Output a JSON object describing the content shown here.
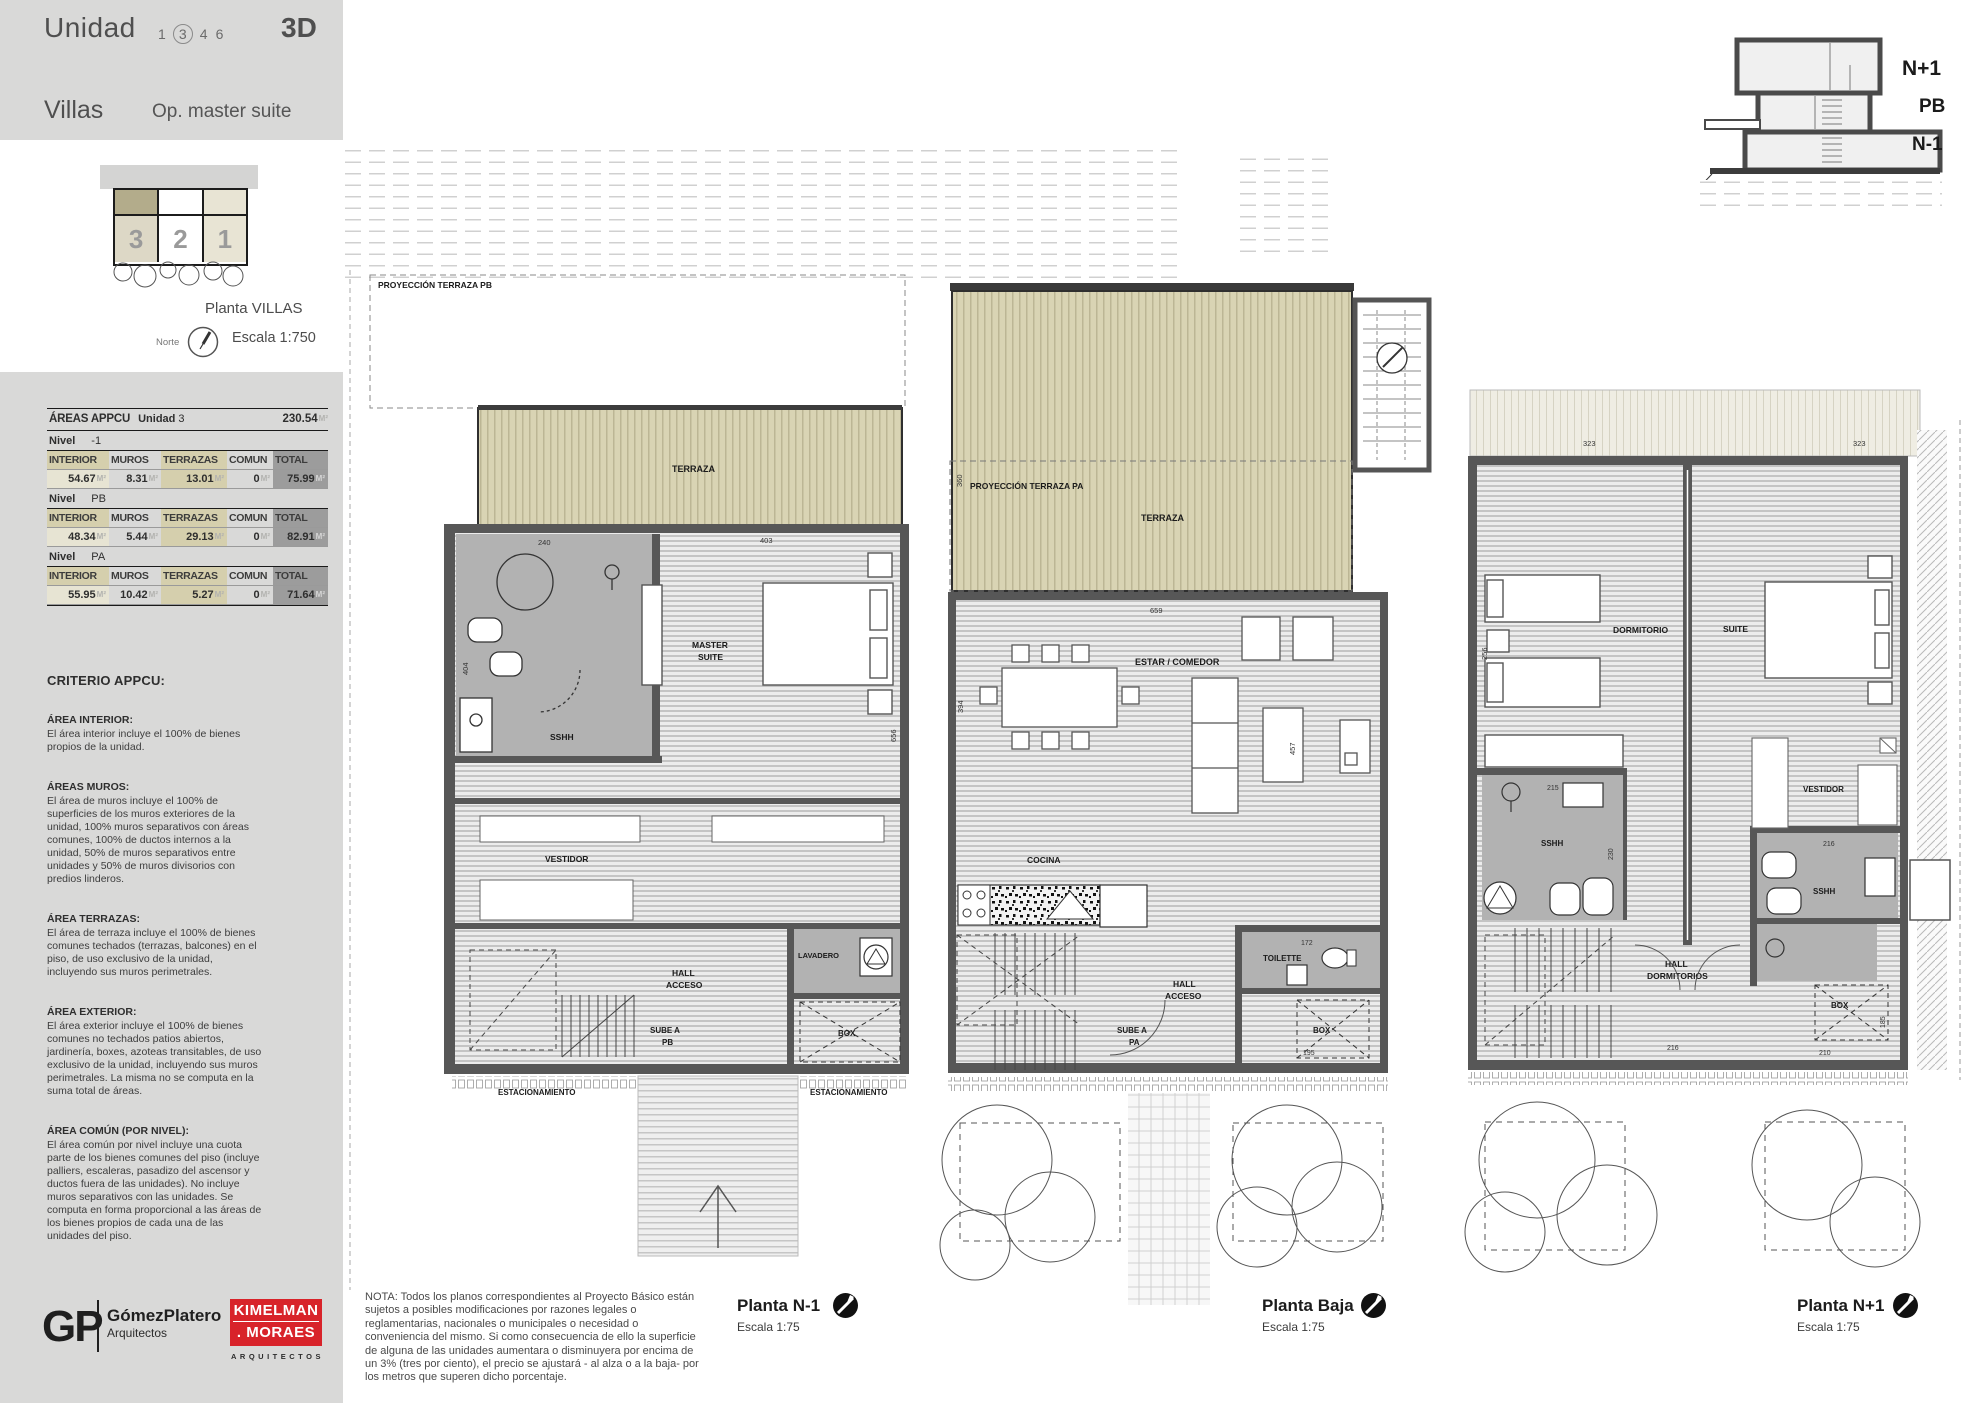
{
  "header": {
    "unidad": "Unidad",
    "units": [
      "1",
      "3",
      "4",
      "6"
    ],
    "selected_unit": "3",
    "code": "3D",
    "villas": "Villas",
    "option": "Op. master suite"
  },
  "siteplan": {
    "numbers": [
      "3",
      "2",
      "1"
    ],
    "title": "Planta VILLAS",
    "scale": "Escala 1:750",
    "north_label": "Norte"
  },
  "areas_table": {
    "title": "ÁREAS APPCU",
    "unit_label": "Unidad",
    "unit_number": "3",
    "total": "230.54",
    "m2": "M²",
    "nivel_label": "Nivel",
    "columns": [
      "INTERIOR",
      "MUROS",
      "TERRAZAS",
      "COMUN",
      "TOTAL"
    ],
    "levels": [
      {
        "nivel": "-1",
        "interior": "54.67",
        "muros": "8.31",
        "terrazas": "13.01",
        "comun": "0",
        "total": "75.99"
      },
      {
        "nivel": "PB",
        "interior": "48.34",
        "muros": "5.44",
        "terrazas": "29.13",
        "comun": "0",
        "total": "82.91"
      },
      {
        "nivel": "PA",
        "interior": "55.95",
        "muros": "10.42",
        "terrazas": "5.27",
        "comun": "0",
        "total": "71.64"
      }
    ]
  },
  "criteria": {
    "title": "CRITERIO APPCU:",
    "sections": [
      {
        "heading": "ÁREA INTERIOR:",
        "body": "El área interior incluye el 100% de bienes propios de la unidad."
      },
      {
        "heading": "ÁREAS MUROS:",
        "body": "El área de muros incluye el 100% de superficies de los muros exteriores de la unidad, 100% muros separativos con áreas comunes, 100% de ductos internos a la unidad, 50% de muros separativos entre unidades y 50% de muros divisorios con predios linderos."
      },
      {
        "heading": "ÁREA TERRAZAS:",
        "body": "El área de terraza incluye el 100% de bienes comunes techados (terrazas, balcones) en el piso, de uso exclusivo de la unidad, incluyendo sus muros perimetrales."
      },
      {
        "heading": "ÁREA EXTERIOR:",
        "body": "El área exterior incluye el 100% de bienes comunes no techados patios abiertos, jardinería, boxes, azoteas transitables, de uso exclusivo de la unidad, incluyendo sus muros perimetrales. La misma no se computa en la suma total de áreas."
      },
      {
        "heading": "ÁREA COMÚN (POR NIVEL):",
        "body": "El área común por nivel incluye una cuota parte de los bienes comunes del piso (incluye palliers, escaleras, pasadizo del ascensor y ductos fuera de las unidades). No incluye muros separativos con las unidades. Se computa en forma proporcional a las áreas de los bienes propios de cada una de las unidades del piso."
      }
    ]
  },
  "section_diagram": {
    "np1_label": "N+1",
    "pb_label": "PB",
    "n1_label": "N-1"
  },
  "plans": {
    "n1": {
      "title": "Planta N-1",
      "scale": "Escala 1:75",
      "projection": "PROYECCIÓN TERRAZA PB",
      "labels": {
        "terraza": "TERRAZA",
        "master_l1": "MASTER",
        "master_l2": "SUITE",
        "sshh": "SSHH",
        "vestidor": "VESTIDOR",
        "hall_l1": "HALL",
        "hall_l2": "ACCESO",
        "sube_l1": "SUBE A",
        "sube_l2": "PB",
        "lavadero": "LAVADERO",
        "box": "BOX",
        "estacionamiento_izq": "ESTACIONAMIENTO",
        "estacionamiento_der": "ESTACIONAMIENTO"
      },
      "dims": {
        "d240": "240",
        "d403": "403",
        "d404": "404",
        "d656": "656"
      }
    },
    "pb": {
      "title": "Planta Baja",
      "scale": "Escala 1:75",
      "projection": "PROYECCIÓN TERRAZA PA",
      "labels": {
        "terraza": "TERRAZA",
        "estar": "ESTAR / COMEDOR",
        "cocina": "COCINA",
        "toilette": "TOILETTE",
        "hall_l1": "HALL",
        "hall_l2": "ACCESO",
        "sube_l1": "SUBE A",
        "sube_l2": "PA",
        "box": "BOX"
      },
      "dims": {
        "d659": "659",
        "d394": "394",
        "d457": "457",
        "d172": "172",
        "d195": "195",
        "d360": "360"
      }
    },
    "np1": {
      "title": "Planta N+1",
      "scale": "Escala 1:75",
      "labels": {
        "dormitorio": "DORMITORIO",
        "suite": "SUITE",
        "vestidor": "VESTIDOR",
        "sshh_izq": "SSHH",
        "sshh_der": "SSHH",
        "hall_l1": "HALL",
        "hall_l2": "DORMITORIOS",
        "box": "BOX"
      },
      "dims": {
        "d323a": "323",
        "d323b": "323",
        "d256": "256",
        "d215": "215",
        "d216a": "216",
        "d216b": "216",
        "d230": "230",
        "d210": "210",
        "d185": "185"
      }
    }
  },
  "footer": {
    "gp": {
      "initials": "GP",
      "name": "GómezPlatero",
      "sub": "Arquitectos"
    },
    "km": {
      "line1": "KIMELMAN",
      "line2": ". MORAES",
      "sub": "ARQUITECTOS"
    },
    "nota": "NOTA: Todos los planos correspondientes al Proyecto Básico están sujetos a posibles modificaciones por razones legales o reglamentarias, nacionales o municipales o necesidad o conveniencia del mismo. Si como consecuencia de ello la superficie de alguna de las unidades aumentara o disminuyera por encima de un 3% (tres por ciento), el precio se ajustará - al alza o a la baja- por los metros que superen dicho porcentaje."
  },
  "colors": {
    "sidebar_gray": "#d9d9d8",
    "terrace_beige": "#d9d4b4",
    "table_highlight": "#d5cfad",
    "total_bg": "#9c9c9c",
    "logo_red": "#d8232a",
    "wall_gray": "#575757"
  }
}
